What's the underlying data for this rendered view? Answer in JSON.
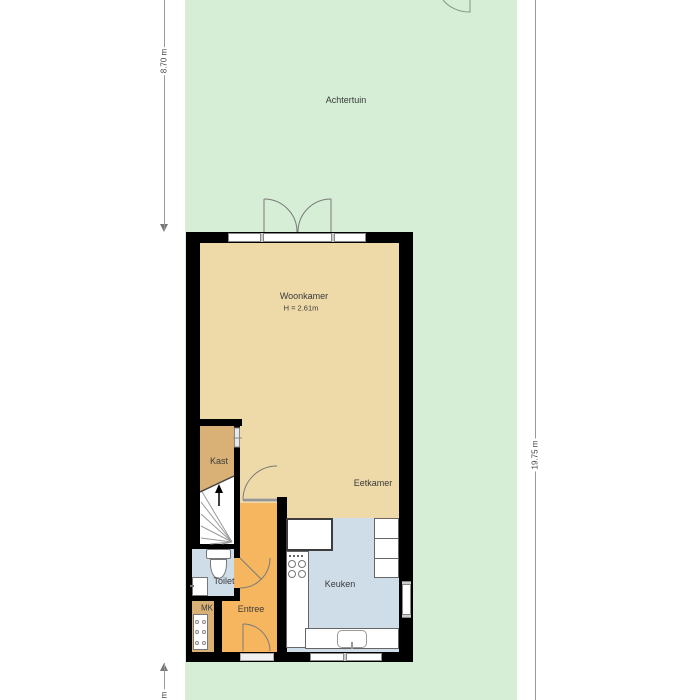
{
  "plan": {
    "labels": {
      "achtertuin": "Achtertuin",
      "woonkamer": "Woonkamer",
      "woonkamer_height": "H = 2.61m",
      "eetkamer": "Eetkamer",
      "kast": "Kast",
      "toilet": "Toilet",
      "mk": "MK",
      "entree": "Entree",
      "keuken": "Keuken"
    },
    "dimensions": {
      "garden_depth": "8.70 m",
      "plot_depth": "19.75 m",
      "bottom_partial": "m"
    },
    "colors": {
      "garden": "#d5eed5",
      "floor_living": "#eed9a9",
      "floor_kast": "#d9b177",
      "floor_hall": "#f6b65f",
      "floor_wet": "#cfdde9",
      "wall": "#000000"
    }
  }
}
